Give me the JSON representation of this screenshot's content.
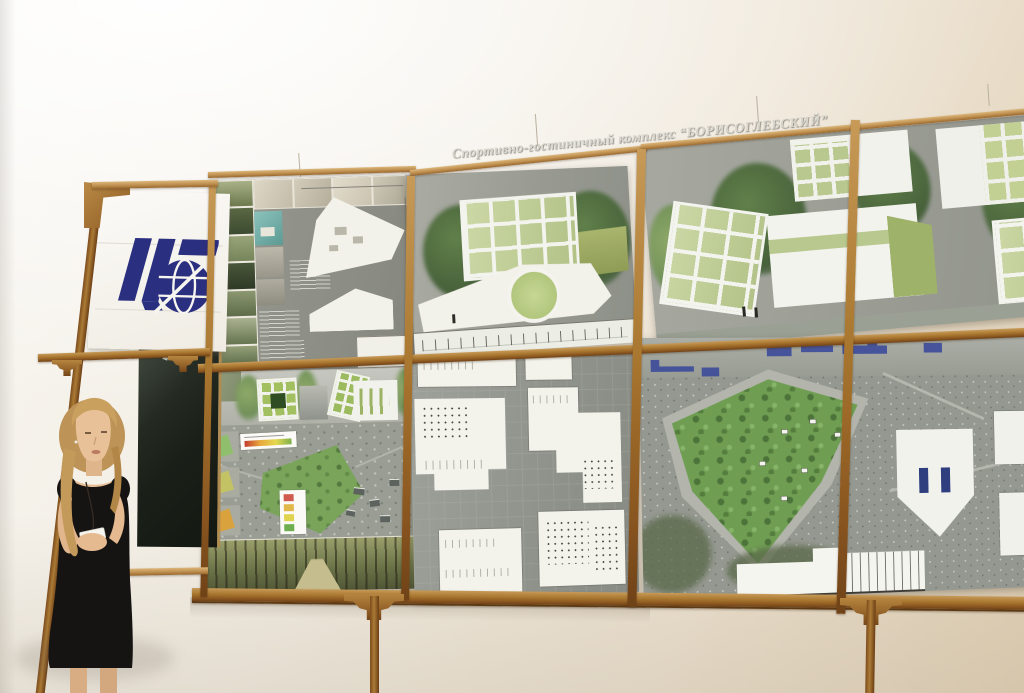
{
  "scene": {
    "setting": "exhibition wall with architectural competition boards on a wooden display frame",
    "board_title": "Спортивно-гостиничный комплекс “БОРИСОГЛЕБСКИЙ”",
    "presenter": "young woman in a black dress holding notes",
    "logo": "institute-globe-logo"
  },
  "colors": {
    "wall_top": "#f8f6f1",
    "wall_bottom": "#decdb1",
    "wood": "#9a6630",
    "board_gray": "#969890",
    "logo_navy": "#2b2f80",
    "park_green": "#6f9e53",
    "banner_white": "#fbfaf7",
    "dress_black": "#161313"
  }
}
